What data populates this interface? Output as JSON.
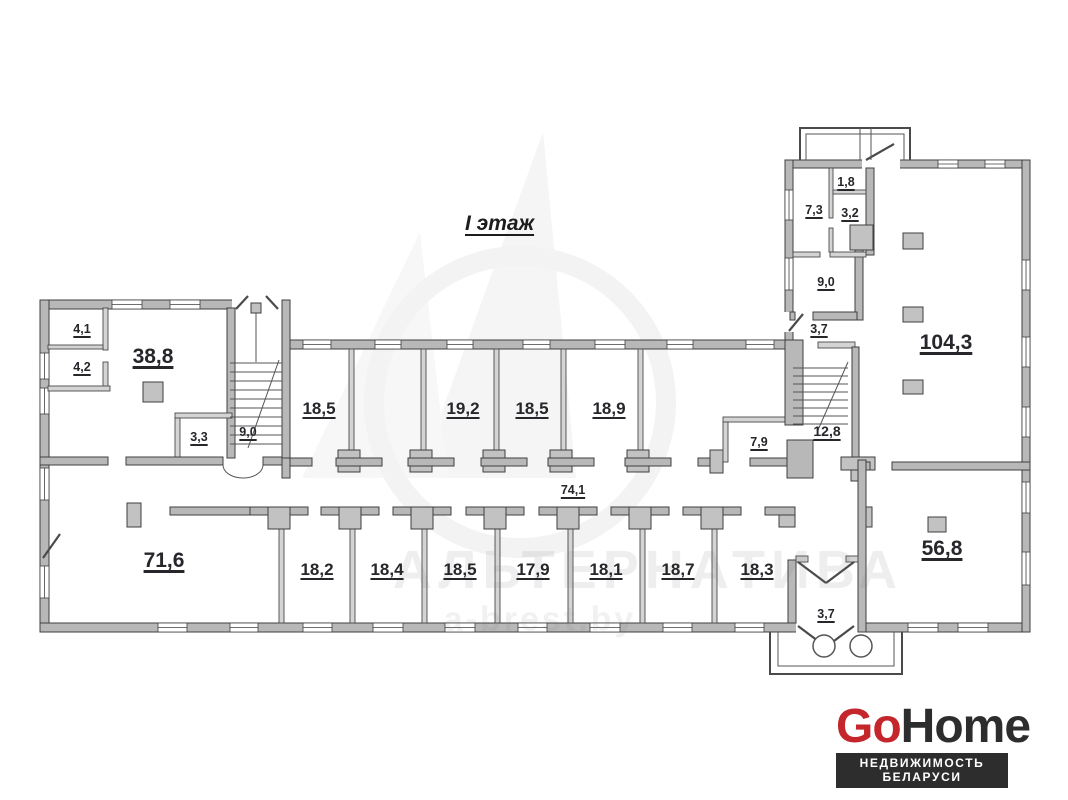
{
  "title": "I этаж",
  "watermark": {
    "line1": "АЛЬТЕРНАТИВА",
    "line2": "a-brest.by"
  },
  "rooms": [
    {
      "name": "room-4-1",
      "area": "4,1"
    },
    {
      "name": "room-4-2",
      "area": "4,2"
    },
    {
      "name": "room-38-8",
      "area": "38,8"
    },
    {
      "name": "room-3-3",
      "area": "3,3"
    },
    {
      "name": "stair-9-0-left",
      "area": "9,0"
    },
    {
      "name": "room-18-5-a",
      "area": "18,5"
    },
    {
      "name": "room-19-2",
      "area": "19,2"
    },
    {
      "name": "room-18-5-b",
      "area": "18,5"
    },
    {
      "name": "room-18-9",
      "area": "18,9"
    },
    {
      "name": "room-7-9",
      "area": "7,9"
    },
    {
      "name": "room-3-7-mid",
      "area": "3,7"
    },
    {
      "name": "stair-12-8",
      "area": "12,8"
    },
    {
      "name": "room-1-8",
      "area": "1,8"
    },
    {
      "name": "room-7-3",
      "area": "7,3"
    },
    {
      "name": "room-3-2",
      "area": "3,2"
    },
    {
      "name": "room-9-0-right",
      "area": "9,0"
    },
    {
      "name": "room-104-3",
      "area": "104,3"
    },
    {
      "name": "corridor-74-1",
      "area": "74,1"
    },
    {
      "name": "room-71-6",
      "area": "71,6"
    },
    {
      "name": "room-18-2",
      "area": "18,2"
    },
    {
      "name": "room-18-4",
      "area": "18,4"
    },
    {
      "name": "room-18-5-c",
      "area": "18,5"
    },
    {
      "name": "room-17-9",
      "area": "17,9"
    },
    {
      "name": "room-18-1",
      "area": "18,1"
    },
    {
      "name": "room-18-7",
      "area": "18,7"
    },
    {
      "name": "room-18-3",
      "area": "18,3"
    },
    {
      "name": "room-3-7-entry",
      "area": "3,7"
    },
    {
      "name": "room-56-8",
      "area": "56,8"
    }
  ],
  "logo": {
    "part1": "Go",
    "part2": "Home",
    "tagline": "НЕДВИЖИМОСТЬ БЕЛАРУСИ",
    "accent_color": "#c4262c",
    "dark_color": "#2d2d2d"
  }
}
